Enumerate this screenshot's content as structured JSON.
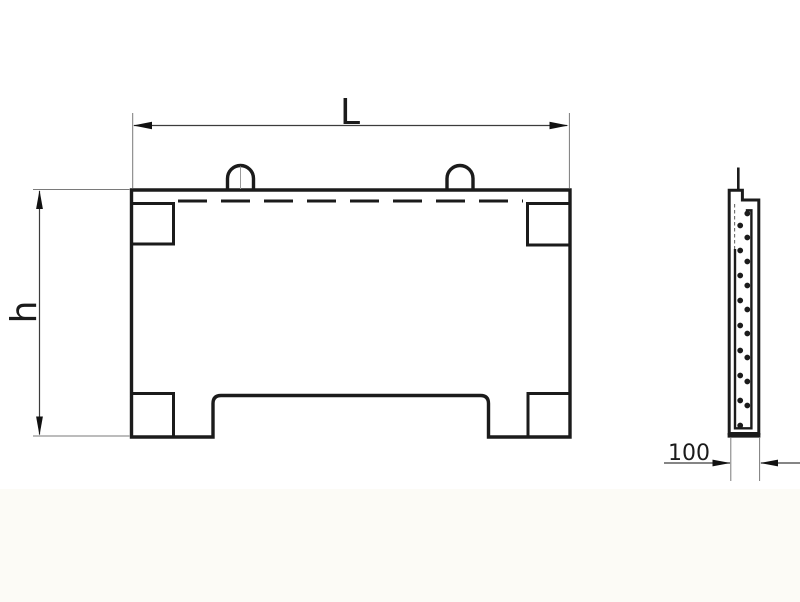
{
  "page": {
    "background": "#ffffff",
    "footer_tint": "#fcfbf6"
  },
  "drawing": {
    "description": "technical drawing of a reinforced concrete panel, front view and side section",
    "labels": {
      "length": "L",
      "height": "h",
      "thickness": "100"
    },
    "colors": {
      "line": "#1b1b1b",
      "thin_line": "#7a7a7a",
      "dim_line": "#3c3c3c",
      "arrow": "#111111",
      "fill": "#ffffff"
    }
  }
}
